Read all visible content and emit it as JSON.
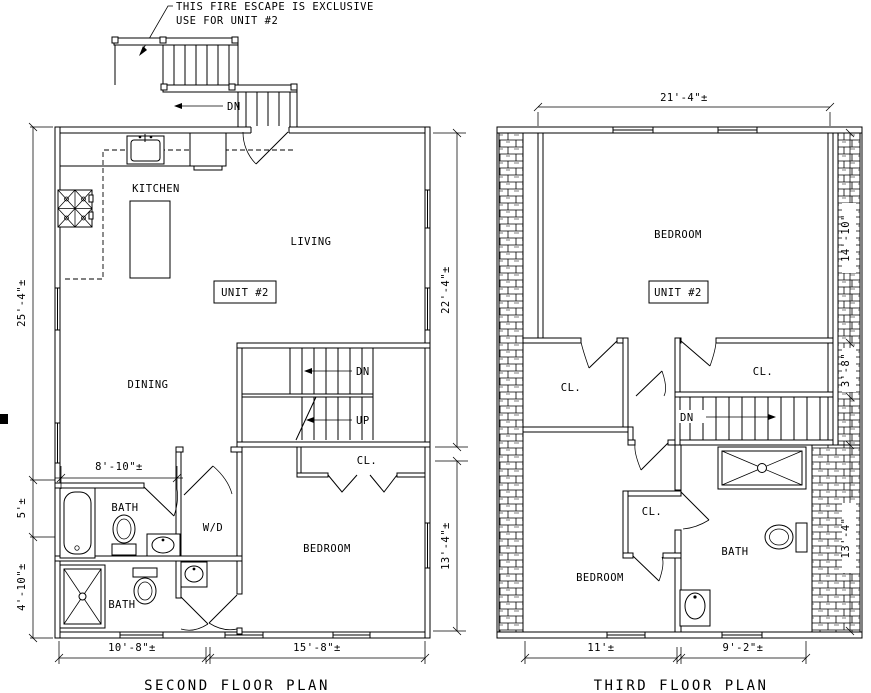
{
  "canvas": {
    "background": "#ffffff",
    "ink": "#000000"
  },
  "annotation": {
    "line1": "THIS FIRE ESCAPE IS EXCLUSIVE",
    "line2": "USE FOR UNIT #2"
  },
  "second_floor": {
    "title": "SECOND FLOOR PLAN",
    "unit_label": "UNIT #2",
    "rooms": {
      "kitchen": "KITCHEN",
      "living": "LIVING",
      "dining": "DINING",
      "bedroom": "BEDROOM",
      "bath_upper": "BATH",
      "bath_lower": "BATH",
      "washer_dryer": "W/D",
      "closet": "CL."
    },
    "stairs": {
      "fire_escape_down": "DN",
      "down": "DN",
      "up": "UP"
    },
    "dimensions": {
      "left_upper": "25'-4\"±",
      "left_middle": "5'±",
      "left_lower": "4'-10\"±",
      "bath_width": "8'-10\"±",
      "right_upper": "22'-4\"±",
      "right_lower": "13'-4\"±",
      "bottom_left": "10'-8\"±",
      "bottom_right": "15'-8\"±"
    }
  },
  "third_floor": {
    "title": "THIRD FLOOR PLAN",
    "unit_label": "UNIT #2",
    "rooms": {
      "bedroom_upper": "BEDROOM",
      "bedroom_lower": "BEDROOM",
      "bath": "BATH",
      "closet_left": "CL.",
      "closet_right": "CL.",
      "closet_lower": "CL."
    },
    "stairs": {
      "down": "DN"
    },
    "dimensions": {
      "top": "21'-4\"±",
      "right_upper": "14'-10\"",
      "right_middle": "3'-8\"",
      "right_lower": "13'-4\"",
      "bottom_left": "11'±",
      "bottom_right": "9'-2\"±"
    }
  }
}
